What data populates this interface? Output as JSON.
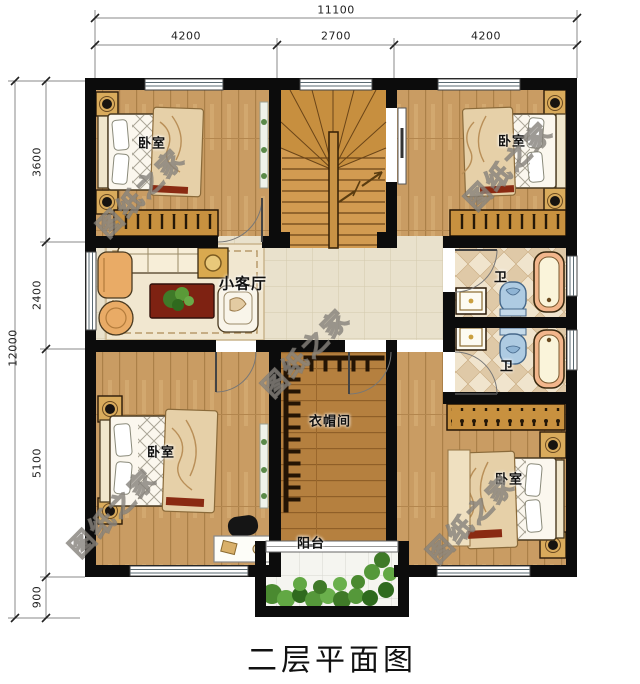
{
  "title": "二层平面图",
  "watermark_text": "图纸之家",
  "dimensions": {
    "top": {
      "total": "11100",
      "segments": [
        "4200",
        "2700",
        "4200"
      ]
    },
    "left": {
      "total": "12000",
      "segments": [
        "3600",
        "2400",
        "5100",
        "900"
      ]
    }
  },
  "rooms": {
    "bedroom_top_left": "卧室",
    "bedroom_top_right": "卧室",
    "bedroom_bottom_left": "卧室",
    "bedroom_bottom_right": "卧室",
    "living_room": "小客厅",
    "bathroom_upper": "卫",
    "bathroom_lower": "卫",
    "cloakroom": "衣帽间",
    "balcony": "阳台"
  },
  "colors": {
    "wall": "#0c0c0c",
    "wood_floor": "#c99c63",
    "wood_dark": "#b5803f",
    "tile_hall": "#e9e1cc",
    "tile_bath": "#f0e4cd",
    "tile_balcony": "#f5f5f0",
    "stair_wood": "#d29b51",
    "tub_rim": "#f2b68c",
    "toilet_blue": "#aecbe2",
    "plant_green": "#4a8a30"
  }
}
